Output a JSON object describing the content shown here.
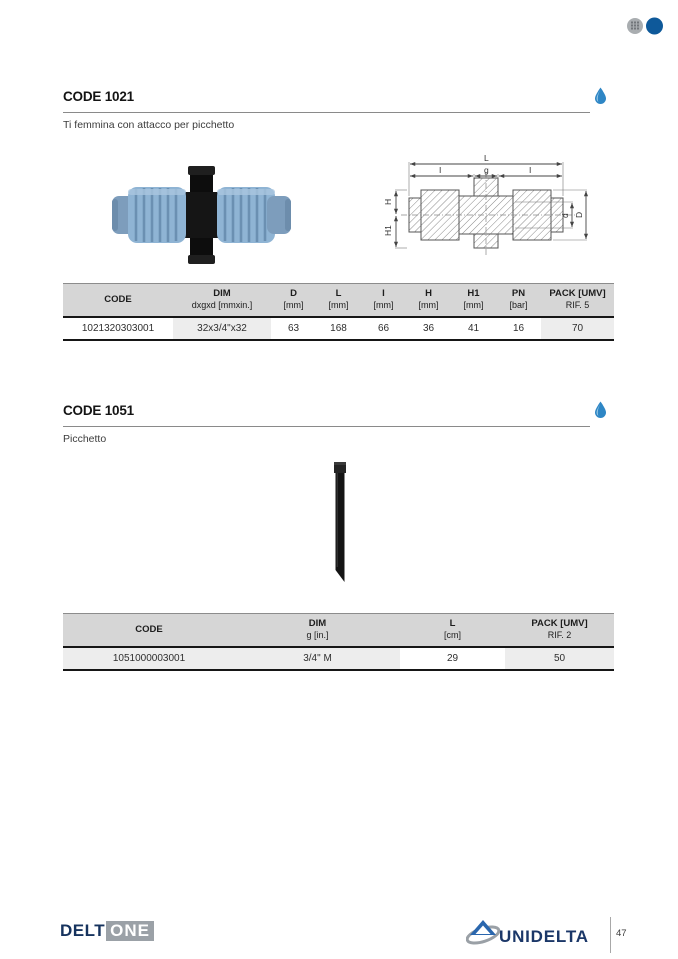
{
  "section1": {
    "title": "CODE 1021",
    "subtitle": "Ti femmina con attacco per picchetto",
    "drawing": {
      "dim_L": "L",
      "dim_I_left": "I",
      "dim_g": "g",
      "dim_I_right": "I",
      "dim_H": "H",
      "dim_H1": "H1",
      "dim_d": "d",
      "dim_D": "D"
    },
    "table": {
      "headers": [
        {
          "line1": "CODE",
          "line2": ""
        },
        {
          "line1": "DIM",
          "line2": "dxgxd [mmxin.]"
        },
        {
          "line1": "D",
          "line2": "[mm]"
        },
        {
          "line1": "L",
          "line2": "[mm]"
        },
        {
          "line1": "I",
          "line2": "[mm]"
        },
        {
          "line1": "H",
          "line2": "[mm]"
        },
        {
          "line1": "H1",
          "line2": "[mm]"
        },
        {
          "line1": "PN",
          "line2": "[bar]"
        },
        {
          "line1": "PACK [UMV]",
          "line2": "RIF. 5"
        }
      ],
      "row": {
        "code": "1021320303001",
        "dim": "32x3/4\"x32",
        "d": "63",
        "l": "168",
        "i": "66",
        "h": "36",
        "h1": "41",
        "pn": "16",
        "pack": "70"
      }
    }
  },
  "section2": {
    "title": "CODE 1051",
    "subtitle": "Picchetto",
    "table": {
      "headers": [
        {
          "line1": "CODE",
          "line2": ""
        },
        {
          "line1": "DIM",
          "line2": "g [in.]"
        },
        {
          "line1": "L",
          "line2": "[cm]"
        },
        {
          "line1": "PACK [UMV]",
          "line2": "RIF. 2"
        }
      ],
      "row": {
        "code": "1051000003001",
        "dim": "3/4\" M",
        "l": "29",
        "pack": "50"
      }
    }
  },
  "footer": {
    "brand_left_part1": "DELT",
    "brand_left_part2": "ONE",
    "brand_right": "UNIDELTA",
    "page_number": "47"
  },
  "colors": {
    "accent_blue": "#2e86c5",
    "navy": "#16335e",
    "logo_blue": "#2a66ad",
    "sphere_blue": "#0e599a",
    "sphere_gray": "#a9adb0",
    "header_gray": "#d6d6d6",
    "shade_gray": "#ededed",
    "nut_blue": "#8fb4d4"
  }
}
